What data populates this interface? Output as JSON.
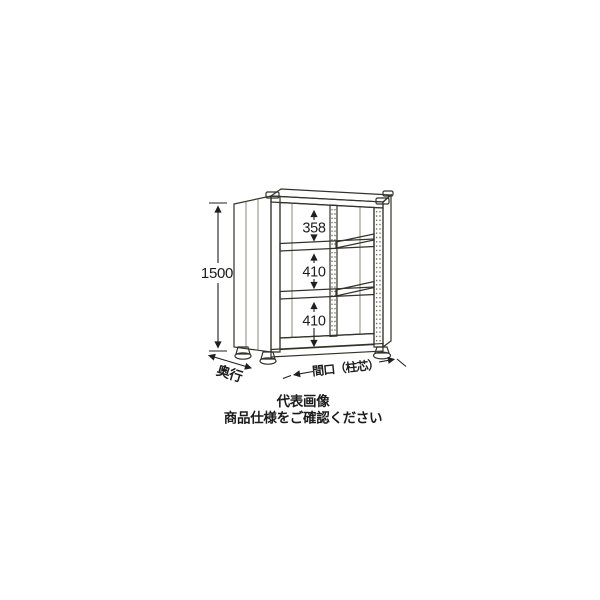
{
  "diagram": {
    "type": "product-technical-drawing",
    "subject": "steel-shelving-unit-3-shelves",
    "dimensions": {
      "height": "1500",
      "gap_top": "358",
      "gap_middle": "410",
      "gap_bottom": "410",
      "depth_label": "奥行",
      "width_label": "間口（柱芯）"
    },
    "caption": {
      "line1": "代表画像",
      "line2": "商品仕様をご確認ください"
    },
    "colors": {
      "background": "#ffffff",
      "panel_cream": "#f9f5d2",
      "panel_side": "#eee7bc",
      "panel_shade": "#e6ddae",
      "outline": "#33332a",
      "dimension_text": "#1c1c1c"
    }
  }
}
